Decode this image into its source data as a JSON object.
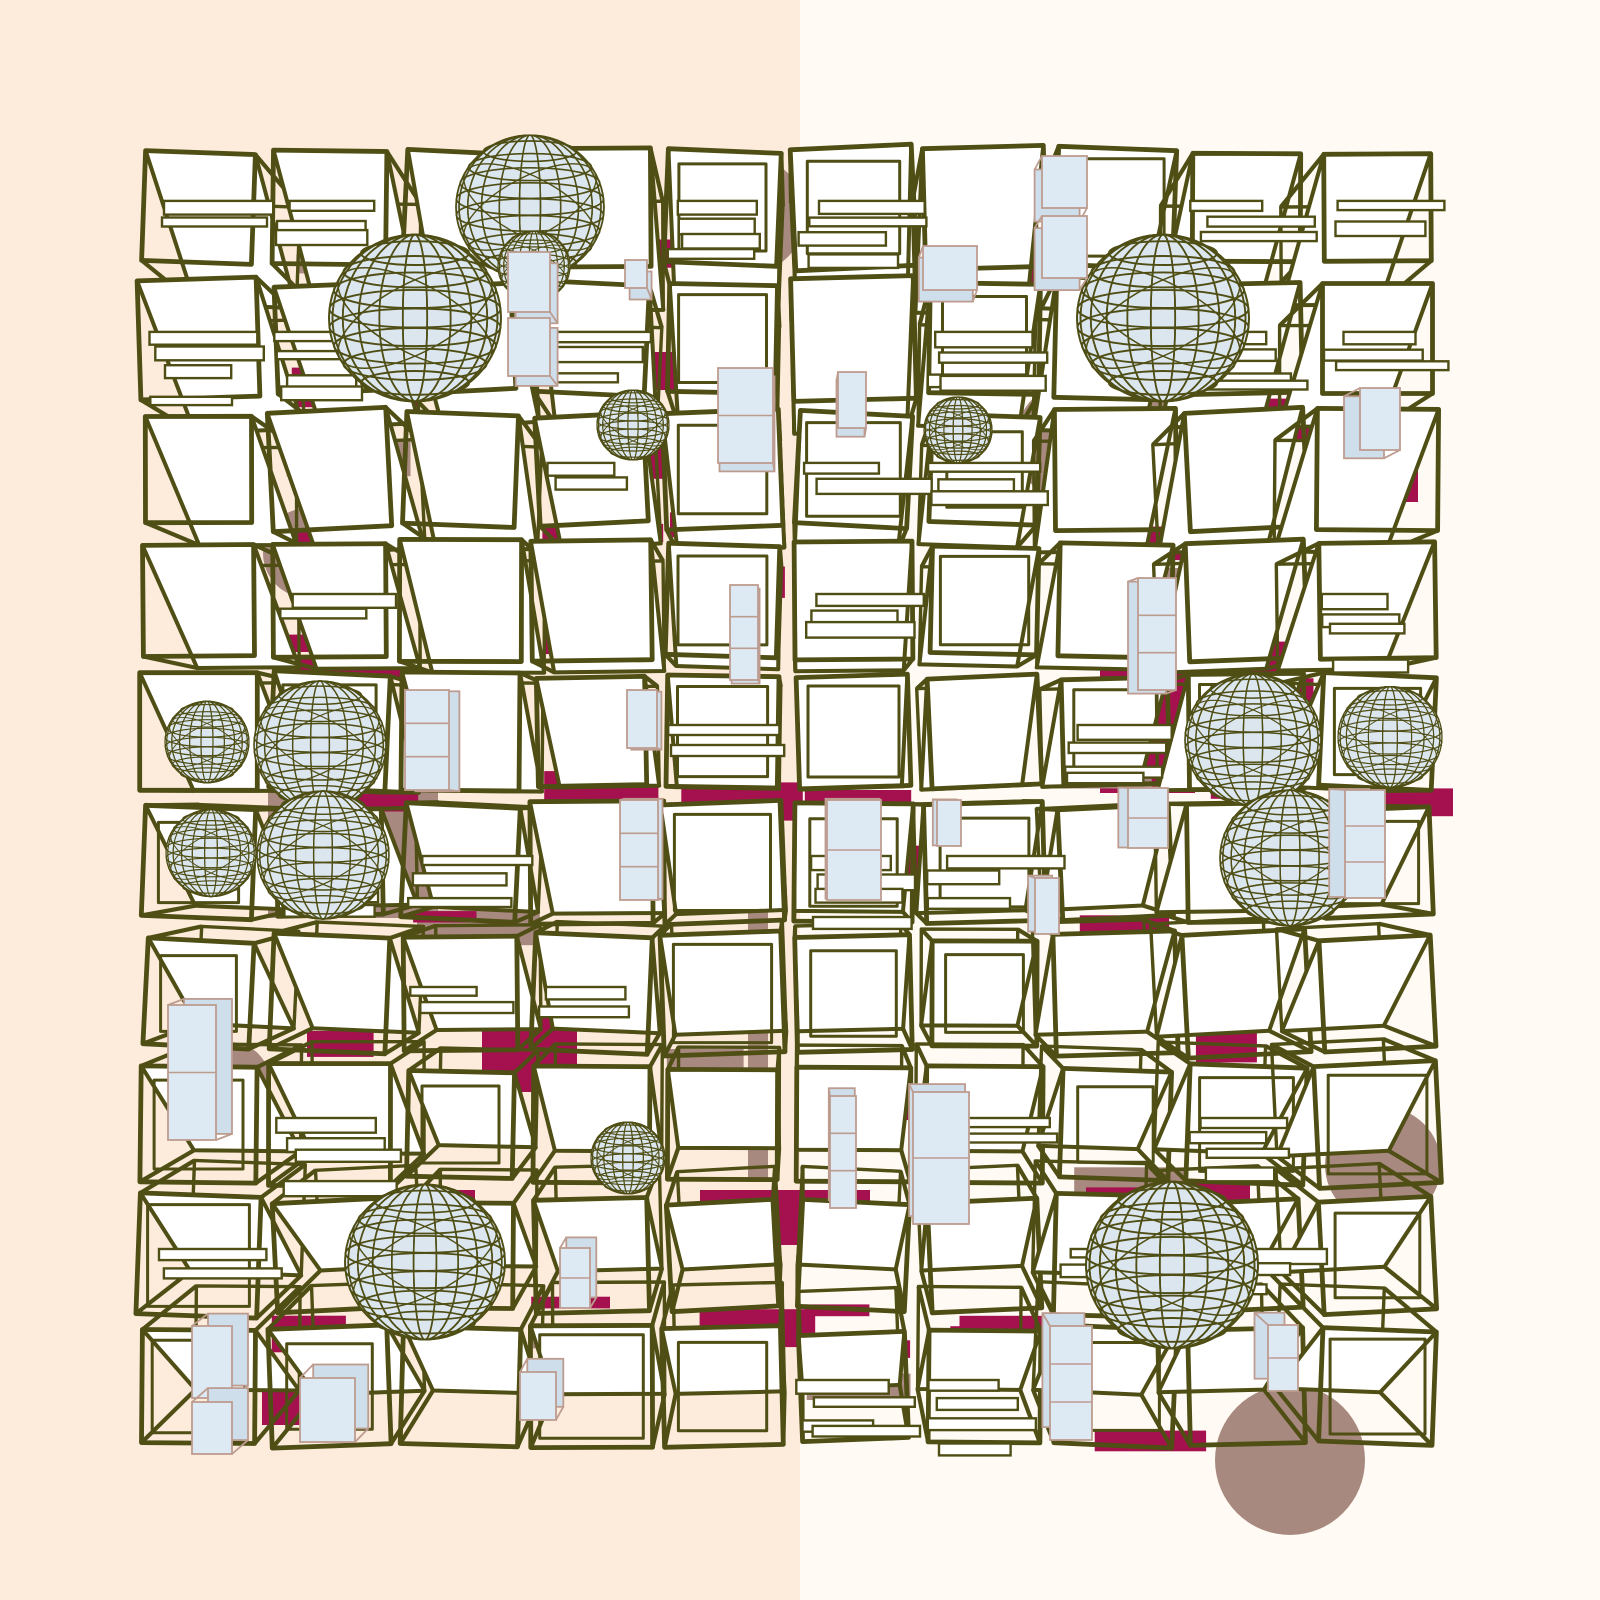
{
  "canvas": {
    "width": 1600,
    "height": 1600
  },
  "background": {
    "split_x": 800,
    "left_color": "#fdecdc",
    "right_color": "#fffbf4"
  },
  "palette": {
    "olive": "#4f4e15",
    "crimson": "#a4114e",
    "mauve": "#a8897f",
    "white": "#ffffff",
    "box_fill": "#dde9f3",
    "box_back_fill": "#cfdeeb",
    "box_edge": "#bd9c90",
    "sphere_fill": "#dce6ef"
  },
  "grid": {
    "cols": 10,
    "rows": 10,
    "x0": 133,
    "y0": 142,
    "cell": 131,
    "cube_size": 114,
    "vanishing_point": {
      "x": 800,
      "y": 797
    },
    "depth": 0.082,
    "seed": 20240613,
    "stripe_chance": 0.42,
    "stripe_mauve_ratio": 0.18,
    "slat_chance": 0.3,
    "double_line_chance": 0.4
  },
  "spheres": [
    {
      "x": 530,
      "y": 207,
      "r": 74
    },
    {
      "x": 534,
      "y": 266,
      "r": 36
    },
    {
      "x": 415,
      "y": 318,
      "r": 86
    },
    {
      "x": 1163,
      "y": 318,
      "r": 86
    },
    {
      "x": 633,
      "y": 425,
      "r": 36
    },
    {
      "x": 958,
      "y": 430,
      "r": 34
    },
    {
      "x": 207,
      "y": 742,
      "r": 42
    },
    {
      "x": 320,
      "y": 745,
      "r": 66
    },
    {
      "x": 211,
      "y": 853,
      "r": 45
    },
    {
      "x": 323,
      "y": 855,
      "r": 66
    },
    {
      "x": 1253,
      "y": 740,
      "r": 68
    },
    {
      "x": 1390,
      "y": 737,
      "r": 52
    },
    {
      "x": 1290,
      "y": 858,
      "r": 70
    },
    {
      "x": 425,
      "y": 1262,
      "r": 80
    },
    {
      "x": 1172,
      "y": 1265,
      "r": 86
    },
    {
      "x": 628,
      "y": 1158,
      "r": 37
    }
  ],
  "mauve_shapes": [
    {
      "type": "circle",
      "x": 745,
      "y": 215,
      "r": 60
    },
    {
      "type": "circle",
      "x": 1077,
      "y": 442,
      "r": 62
    },
    {
      "type": "circle",
      "x": 308,
      "y": 553,
      "r": 45
    },
    {
      "type": "circle",
      "x": 225,
      "y": 378,
      "r": 34
    },
    {
      "type": "rect",
      "x": 268,
      "y": 790,
      "w": 170,
      "h": 128
    },
    {
      "type": "circle",
      "x": 352,
      "y": 800,
      "r": 50
    },
    {
      "type": "rect",
      "x": 748,
      "y": 832,
      "w": 20,
      "h": 350
    },
    {
      "type": "rect",
      "x": 1090,
      "y": 568,
      "w": 110,
      "h": 26
    },
    {
      "type": "circle",
      "x": 230,
      "y": 1082,
      "r": 40
    },
    {
      "type": "circle",
      "x": 1383,
      "y": 1165,
      "r": 58
    },
    {
      "type": "circle",
      "x": 1290,
      "y": 1460,
      "r": 75
    }
  ],
  "crimson_patches": [
    {
      "x": 1100,
      "y": 668,
      "w": 95,
      "h": 125
    },
    {
      "x": 1310,
      "y": 430,
      "w": 108,
      "h": 72
    },
    {
      "x": 560,
      "y": 352,
      "w": 125,
      "h": 38
    },
    {
      "x": 1012,
      "y": 250,
      "w": 88,
      "h": 36
    },
    {
      "x": 190,
      "y": 250,
      "w": 62,
      "h": 28
    },
    {
      "x": 430,
      "y": 310,
      "w": 36,
      "h": 90
    },
    {
      "x": 482,
      "y": 1012,
      "w": 95,
      "h": 80
    },
    {
      "x": 415,
      "y": 1190,
      "w": 60,
      "h": 46
    },
    {
      "x": 700,
      "y": 1190,
      "w": 170,
      "h": 55
    },
    {
      "x": 800,
      "y": 1090,
      "w": 110,
      "h": 30
    },
    {
      "x": 1190,
      "y": 1180,
      "w": 60,
      "h": 56
    },
    {
      "x": 1108,
      "y": 196,
      "w": 20,
      "h": 70
    },
    {
      "x": 262,
      "y": 1385,
      "w": 40,
      "h": 40
    }
  ],
  "blue_boxes": [
    {
      "x": 508,
      "y": 252,
      "w": 42,
      "h": 60,
      "seg": 1
    },
    {
      "x": 508,
      "y": 318,
      "w": 42,
      "h": 58,
      "seg": 1
    },
    {
      "x": 625,
      "y": 260,
      "w": 22,
      "h": 28,
      "seg": 1
    },
    {
      "x": 1042,
      "y": 156,
      "w": 45,
      "h": 52,
      "seg": 1
    },
    {
      "x": 1042,
      "y": 216,
      "w": 45,
      "h": 62,
      "seg": 1
    },
    {
      "x": 923,
      "y": 246,
      "w": 54,
      "h": 44,
      "seg": 1
    },
    {
      "x": 718,
      "y": 368,
      "w": 55,
      "h": 95,
      "seg": 2
    },
    {
      "x": 838,
      "y": 372,
      "w": 28,
      "h": 56,
      "seg": 1
    },
    {
      "x": 1360,
      "y": 388,
      "w": 40,
      "h": 62,
      "seg": 1
    },
    {
      "x": 405,
      "y": 690,
      "w": 44,
      "h": 100,
      "seg": 3
    },
    {
      "x": 627,
      "y": 690,
      "w": 30,
      "h": 58,
      "seg": 1
    },
    {
      "x": 620,
      "y": 800,
      "w": 38,
      "h": 100,
      "seg": 3
    },
    {
      "x": 730,
      "y": 585,
      "w": 28,
      "h": 95,
      "seg": 3
    },
    {
      "x": 827,
      "y": 800,
      "w": 54,
      "h": 100,
      "seg": 2
    },
    {
      "x": 1138,
      "y": 578,
      "w": 38,
      "h": 112,
      "seg": 3
    },
    {
      "x": 1345,
      "y": 790,
      "w": 40,
      "h": 108,
      "seg": 3
    },
    {
      "x": 1128,
      "y": 788,
      "w": 40,
      "h": 60,
      "seg": 2
    },
    {
      "x": 937,
      "y": 800,
      "w": 24,
      "h": 46,
      "seg": 1
    },
    {
      "x": 1035,
      "y": 878,
      "w": 24,
      "h": 56,
      "seg": 1
    },
    {
      "x": 168,
      "y": 1005,
      "w": 48,
      "h": 135,
      "seg": 2
    },
    {
      "x": 913,
      "y": 1092,
      "w": 56,
      "h": 132,
      "seg": 2
    },
    {
      "x": 830,
      "y": 1096,
      "w": 26,
      "h": 112,
      "seg": 3
    },
    {
      "x": 560,
      "y": 1248,
      "w": 30,
      "h": 60,
      "seg": 2
    },
    {
      "x": 192,
      "y": 1326,
      "w": 40,
      "h": 72,
      "seg": 1
    },
    {
      "x": 192,
      "y": 1402,
      "w": 40,
      "h": 52,
      "seg": 1
    },
    {
      "x": 300,
      "y": 1378,
      "w": 55,
      "h": 64,
      "seg": 1
    },
    {
      "x": 520,
      "y": 1372,
      "w": 36,
      "h": 48,
      "seg": 1
    },
    {
      "x": 1050,
      "y": 1326,
      "w": 42,
      "h": 114,
      "seg": 3
    },
    {
      "x": 1268,
      "y": 1325,
      "w": 30,
      "h": 66,
      "seg": 2
    }
  ]
}
